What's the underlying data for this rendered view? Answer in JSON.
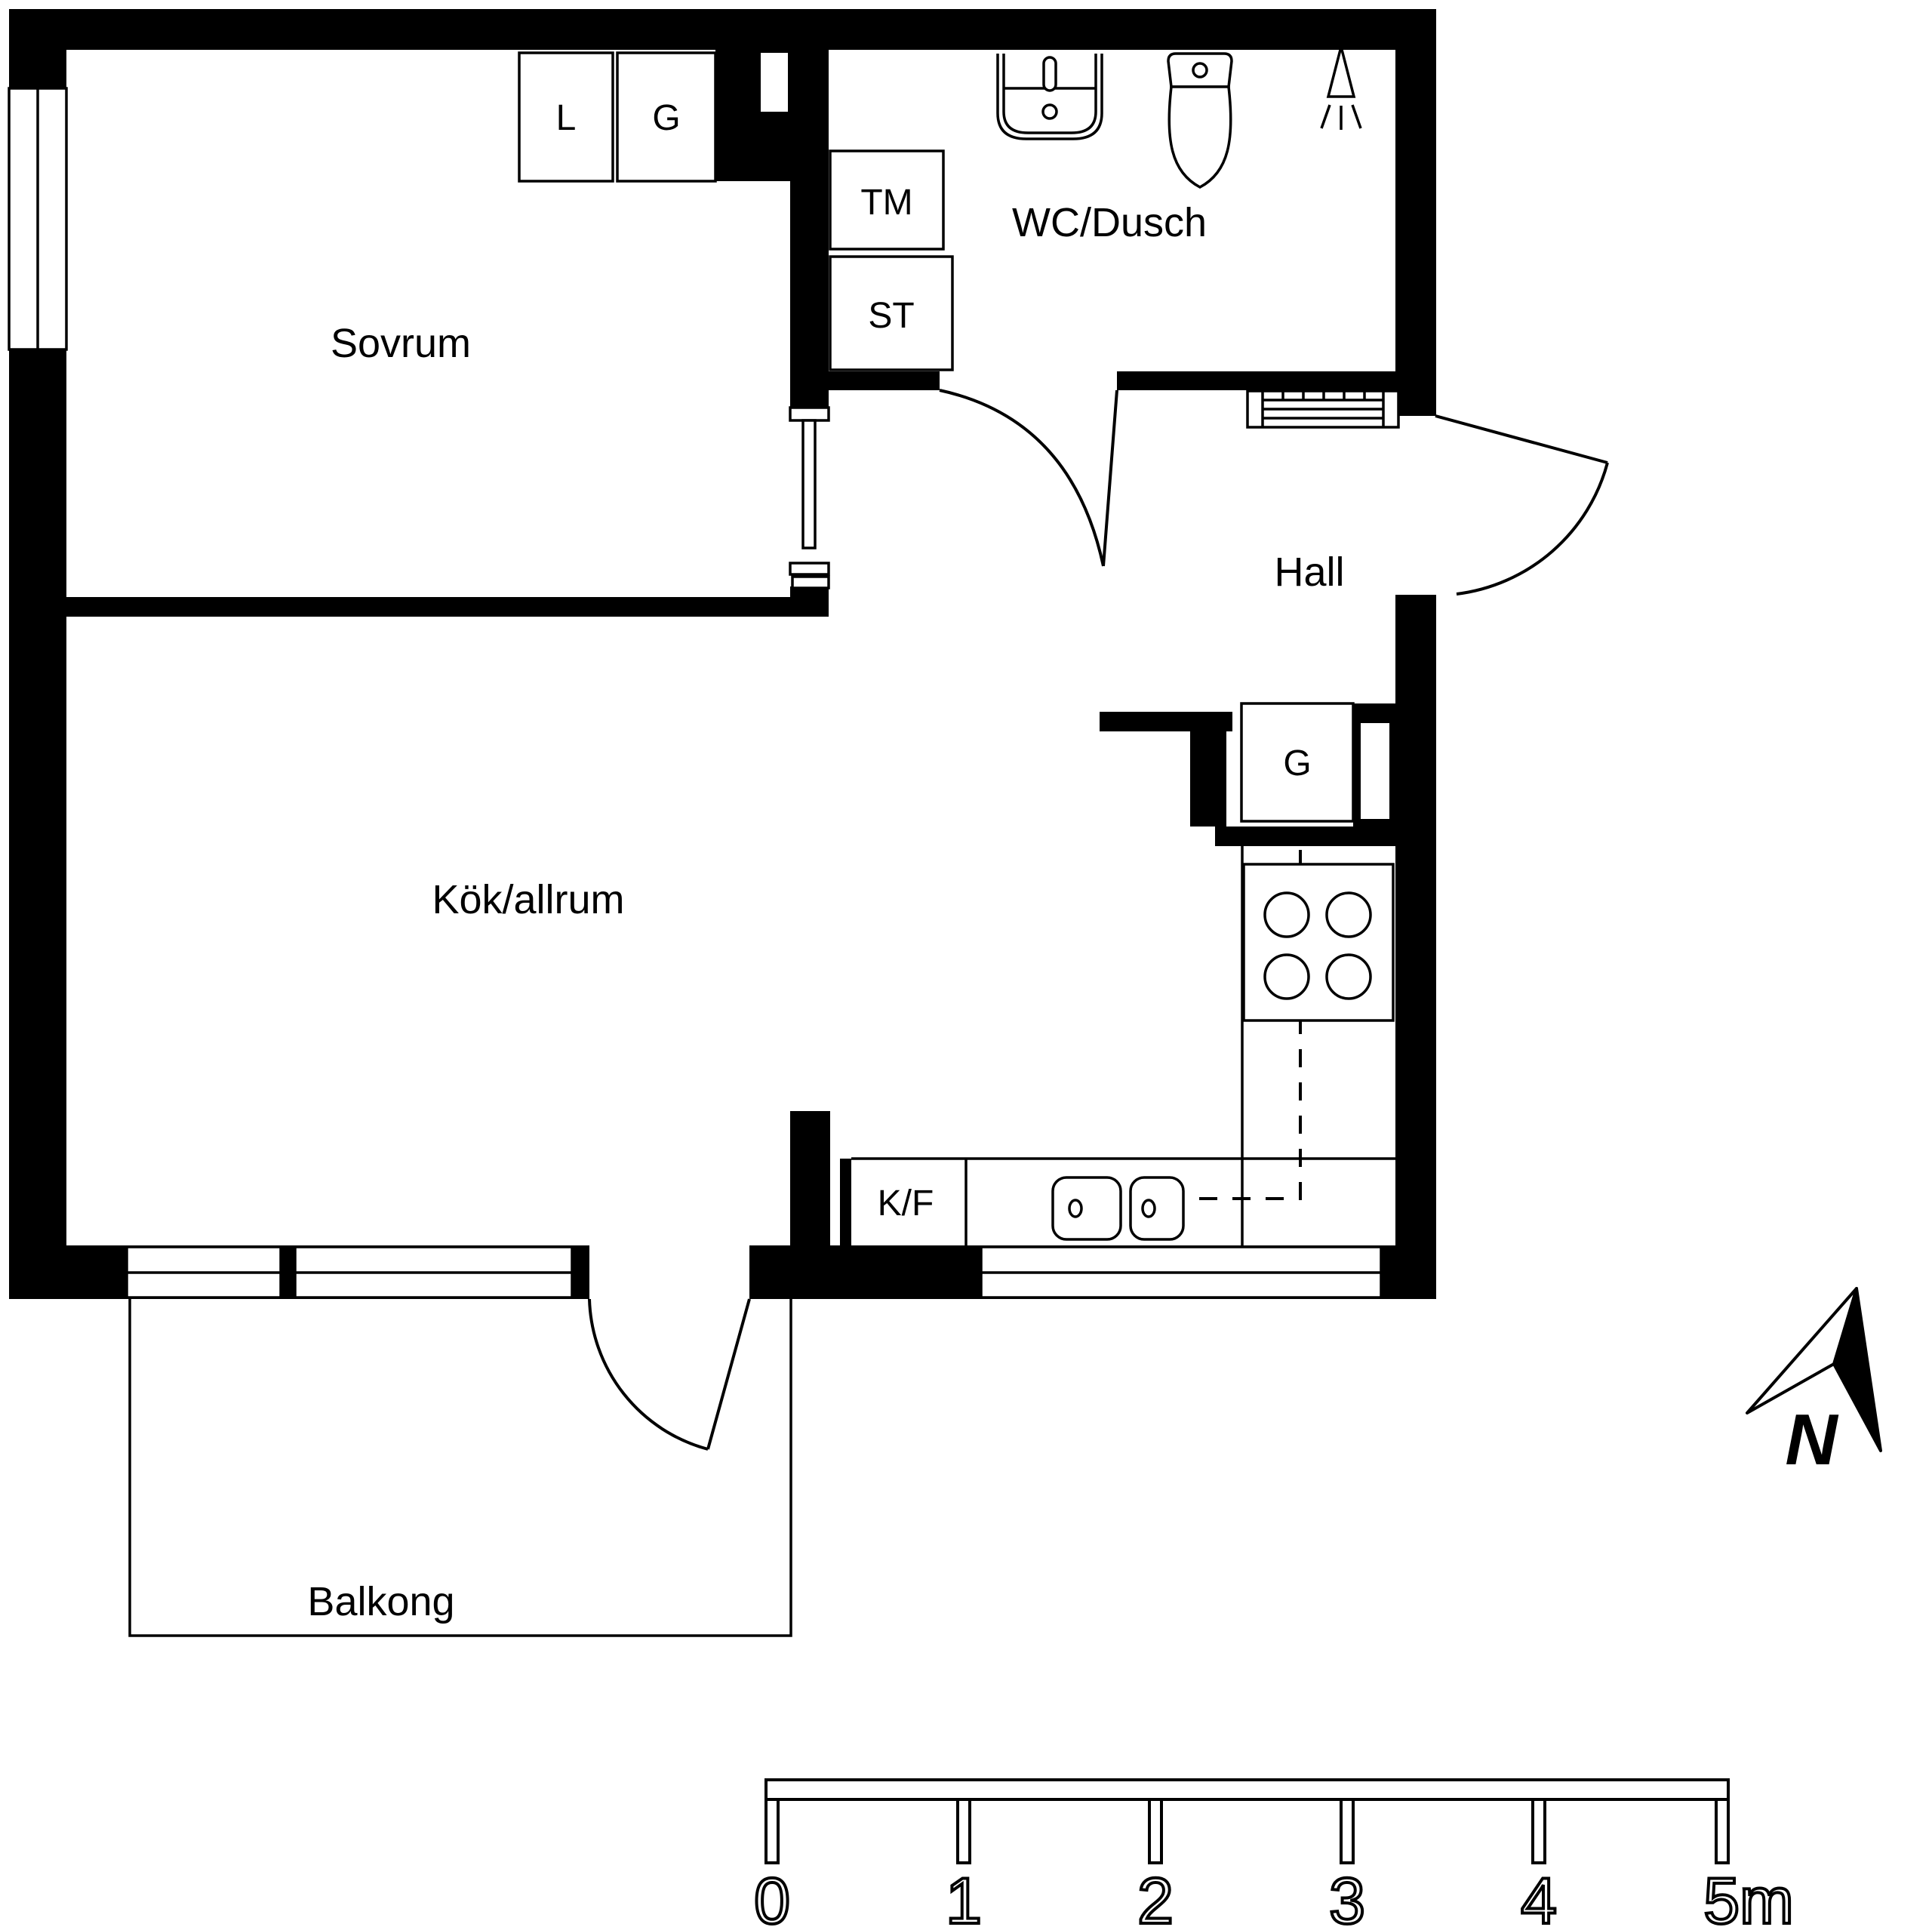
{
  "page": {
    "background_color": "#ffffff",
    "line_color": "#000000",
    "type": "apartment floor plan"
  },
  "floorplan": {
    "rooms": [
      {
        "id": "sovrum",
        "label": "Sovrum"
      },
      {
        "id": "wc-dusch",
        "label": "WC/Dusch"
      },
      {
        "id": "hall",
        "label": "Hall"
      },
      {
        "id": "kok-allrum",
        "label": "Kök/allrum"
      },
      {
        "id": "balkong",
        "label": "Balkong"
      }
    ],
    "closets": [
      {
        "id": "bedroom-closet-l",
        "label": "L"
      },
      {
        "id": "bedroom-closet-g",
        "label": "G"
      },
      {
        "id": "washing-machine",
        "label": "TM"
      },
      {
        "id": "cleaning-closet",
        "label": "ST"
      },
      {
        "id": "kitchen-closet-g",
        "label": "G"
      },
      {
        "id": "fridge-freezer",
        "label": "K/F"
      }
    ],
    "fixtures": [
      "bathroom-sink",
      "toilet",
      "shower",
      "radiator",
      "stove-4-burners",
      "double-kitchen-sink",
      "sliding-door-bedroom",
      "wc-door",
      "entrance-door",
      "balcony-door",
      "window-left",
      "balcony-windows",
      "kitchen-window"
    ],
    "compass": {
      "label": "N"
    },
    "scale_bar": {
      "unit_labels": [
        "0",
        "1",
        "2",
        "3",
        "4",
        "5m"
      ]
    }
  }
}
